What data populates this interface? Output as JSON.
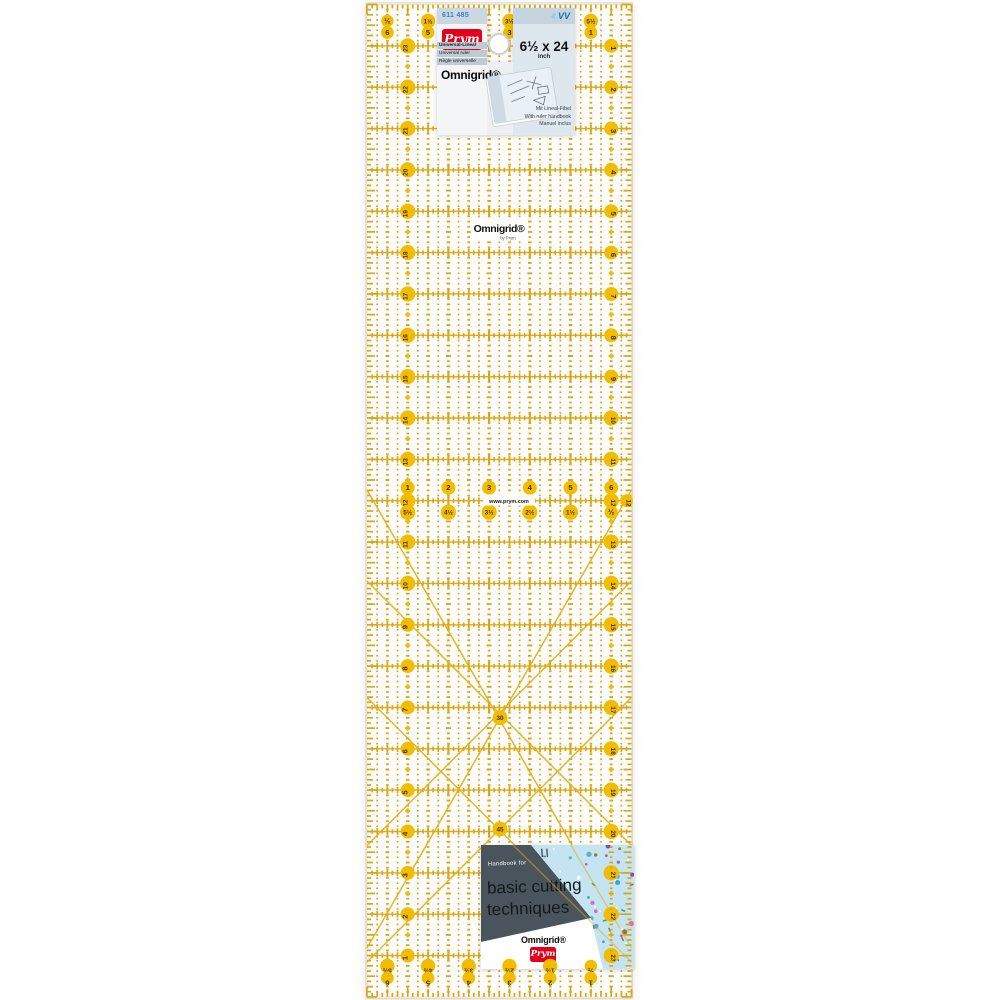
{
  "colors": {
    "gold": "#d9a51a",
    "gold_line": "#dfae14",
    "gold_fill": "#f2bc00",
    "num_text": "#44340a",
    "prym_red": "#e2001a",
    "blue_text": "#3a7fc1",
    "vv_blue": "#1d71b8",
    "slate": "#4a545c",
    "floral_base": "#c3e4f0",
    "title_text": "#15191c"
  },
  "ruler": {
    "left_numbers": [
      "23",
      "22",
      "21",
      "20",
      "19",
      "18",
      "17",
      "16",
      "15",
      "14",
      "13",
      "12",
      "11",
      "10",
      "9",
      "8",
      "7",
      "6",
      "5",
      "4",
      "3",
      "2",
      "1"
    ],
    "right_numbers": [
      "1",
      "2",
      "3",
      "4",
      "5",
      "6",
      "7",
      "8",
      "9",
      "10",
      "11",
      "12",
      "13",
      "14",
      "15",
      "16",
      "17",
      "18",
      "19",
      "20",
      "21",
      "22",
      "23"
    ],
    "top_fractions": [
      "½",
      "1½",
      "2½",
      "3½",
      "4½",
      "5½"
    ],
    "top_integers": [
      "6",
      "5",
      "4",
      "3",
      "2",
      "1"
    ],
    "mid_integers": [
      "1",
      "2",
      "3",
      "4",
      "5",
      "6"
    ],
    "mid_fractions": [
      "5½",
      "4½",
      "3½",
      "2½",
      "1½",
      "½"
    ],
    "bottom_fractions": [
      "5½",
      "4½",
      "3½",
      "2½",
      "1½",
      "½"
    ],
    "bottom_integers": [
      "6",
      "5",
      "4",
      "3",
      "2",
      "1"
    ],
    "angle_30": "30",
    "angle_45": "45",
    "edge_mid_label": "12",
    "center_logo": "Omnigrid®",
    "center_logo_sub": "by Prym",
    "website": "www.prym.com"
  },
  "top_card": {
    "article_no": "611 485",
    "vv": "VV",
    "brand": "Prym",
    "lang_lines": [
      "Universal-Lineal",
      "Universal ruler",
      "Règle universelle"
    ],
    "size": "6½ x 24",
    "unit": "inch",
    "logo": "Omnigrid®",
    "handbook_lines": [
      "Mit Lineal-Fibel",
      "With ruler handbook",
      "Manuel inclus"
    ]
  },
  "bottom_card": {
    "handbook_for": "Handbook for",
    "title_line1": "basic cutting",
    "title_line2": "techniques",
    "logo": "Omnigrid®",
    "brand": "Prym",
    "flower_palette": [
      "#bb4ba4",
      "#7d3f9e",
      "#2f9fd6",
      "#8a7030",
      "#ffffff",
      "#57b0c9",
      "#d95fb5"
    ]
  }
}
